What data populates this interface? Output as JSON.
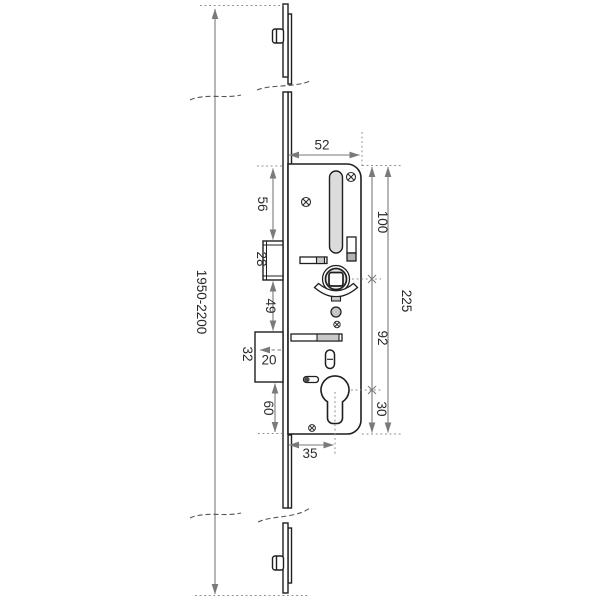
{
  "drawing": {
    "type": "multipoint-door-lock-technical-drawing",
    "colors": {
      "outline": "#1f1f1f",
      "dimension": "#7a7a7a",
      "dotted": "#8a8a8a",
      "fill_light": "#dcdcdc",
      "fill_mid": "#c9c9c9",
      "background": "#ffffff"
    }
  },
  "dimensions": {
    "faceplate_length": "1950-2200",
    "case_top_width": "52",
    "case_top_to_latch": "56",
    "latch_block_height": "28",
    "latch_to_deadbolt": "49",
    "deadbolt_block_height": "32",
    "deadbolt_throw": "20",
    "deadbolt_to_case_bottom": "60",
    "backset": "35",
    "case_top_to_follower": "100",
    "follower_to_cylinder": "92",
    "cylinder_to_case_bottom": "30",
    "case_height": "225"
  }
}
